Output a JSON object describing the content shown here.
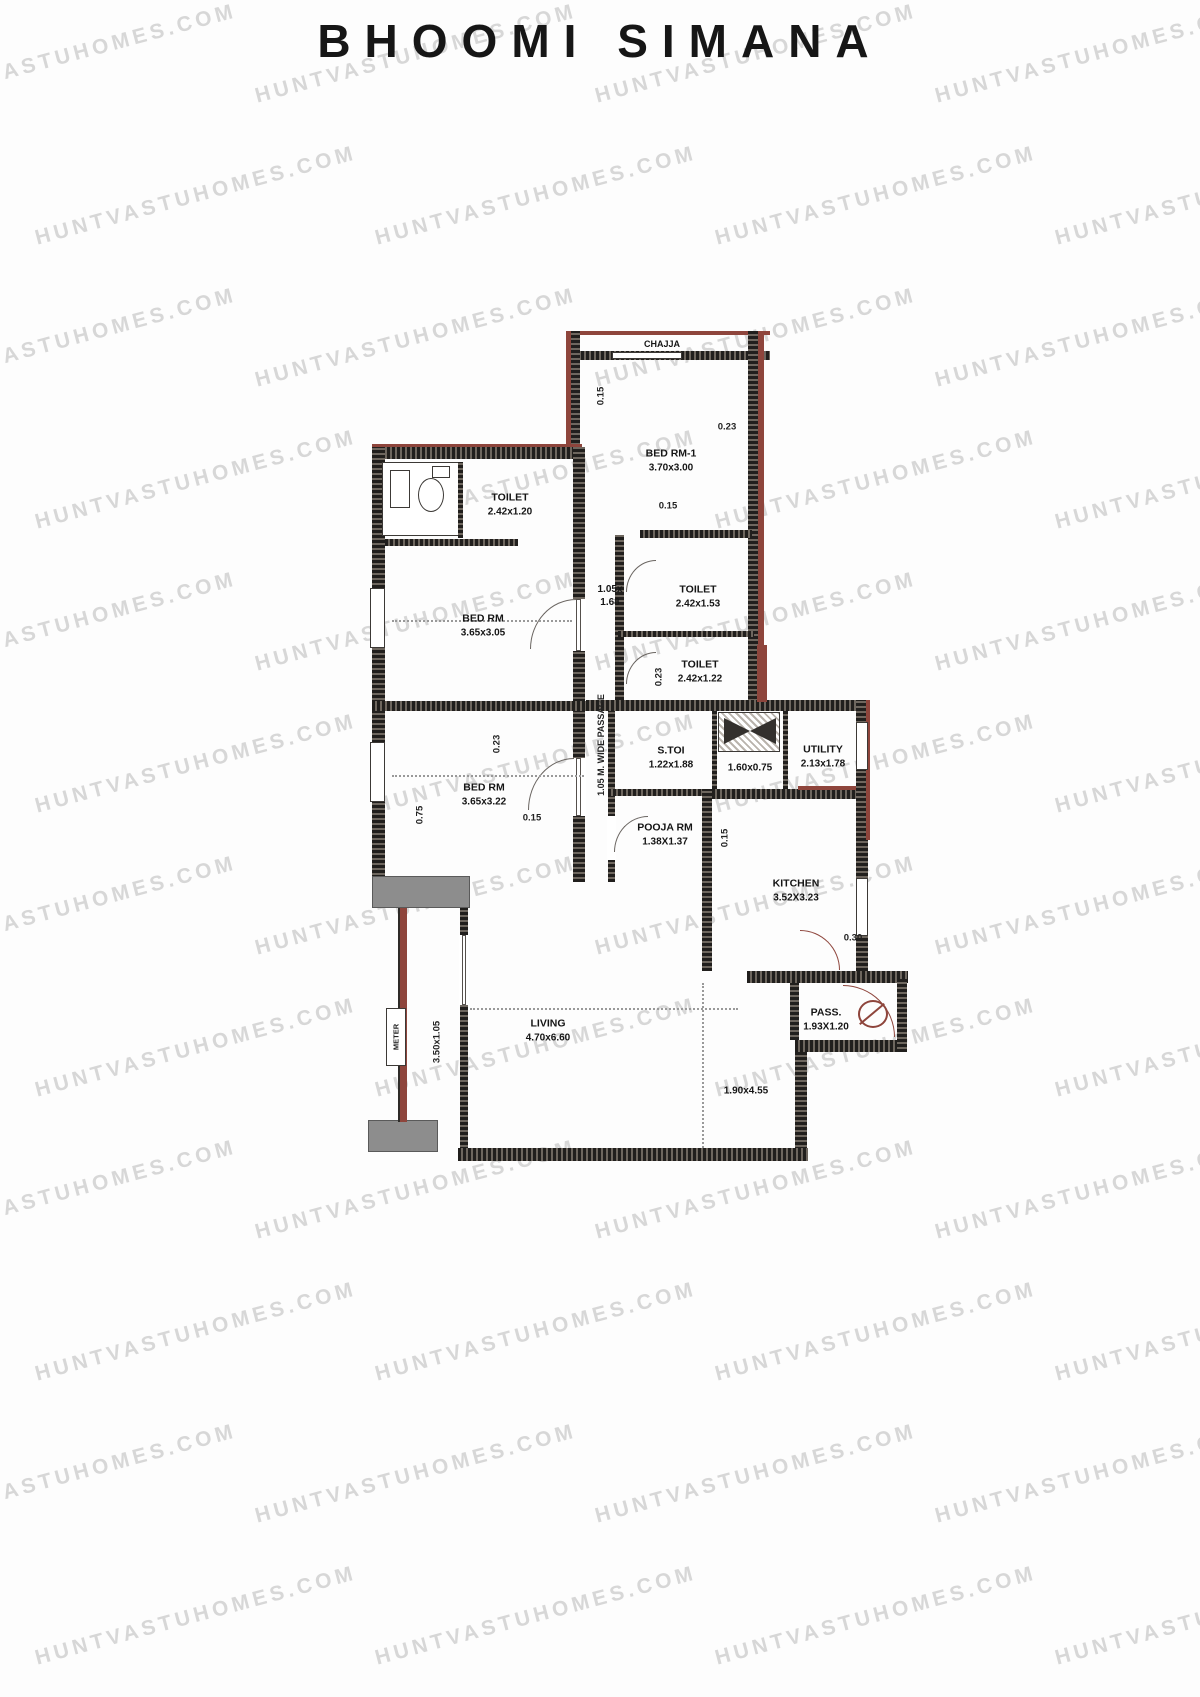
{
  "title": "BHOOMI SIMANA",
  "watermark": {
    "text": "HUNTVASTUHOMES.COM"
  },
  "plan": {
    "chajja_label": "CHAJJA",
    "passage_label": "1.05 M. WIDE PASSAGE",
    "meter_label": "METER",
    "balcony_dim": "3.50x1.05",
    "dining_dim": "1.90x4.55",
    "duct_dim_line1": "1.05x",
    "duct_dim_line2": "1.68",
    "rooms": {
      "bed1": {
        "name": "BED RM-1",
        "dim": "3.70x3.00"
      },
      "toilet1": {
        "name": "TOILET",
        "dim": "2.42x1.20"
      },
      "bed2": {
        "name": "BED RM",
        "dim": "3.65x3.05"
      },
      "toilet2": {
        "name": "TOILET",
        "dim": "2.42x1.53"
      },
      "toilet3": {
        "name": "TOILET",
        "dim": "2.42x1.22"
      },
      "bed3": {
        "name": "BED RM",
        "dim": "3.65x3.22"
      },
      "stoi": {
        "name": "S.TOI",
        "dim": "1.22x1.88"
      },
      "wm_area": {
        "dim": "1.60x0.75"
      },
      "utility": {
        "name": "UTILITY",
        "dim": "2.13x1.78"
      },
      "pooja": {
        "name": "POOJA RM",
        "dim": "1.38X1.37"
      },
      "kitchen": {
        "name": "KITCHEN",
        "dim": "3.52X3.23"
      },
      "pass": {
        "name": "PASS.",
        "dim": "1.93X1.20"
      },
      "living": {
        "name": "LIVING",
        "dim": "4.70x6.60"
      }
    },
    "annotations": [
      {
        "text": "0.15"
      },
      {
        "text": "0.23"
      },
      {
        "text": "0.15"
      },
      {
        "text": "0.23"
      },
      {
        "text": "0.23"
      },
      {
        "text": "0.15"
      },
      {
        "text": "0.75"
      },
      {
        "text": "0.15"
      },
      {
        "text": "0.30"
      }
    ],
    "colors": {
      "wall": "#2e2b28",
      "accent_red": "#8e453c",
      "block_gray": "#8d8d8d",
      "watermark_gray": "#d7d7d7"
    }
  }
}
